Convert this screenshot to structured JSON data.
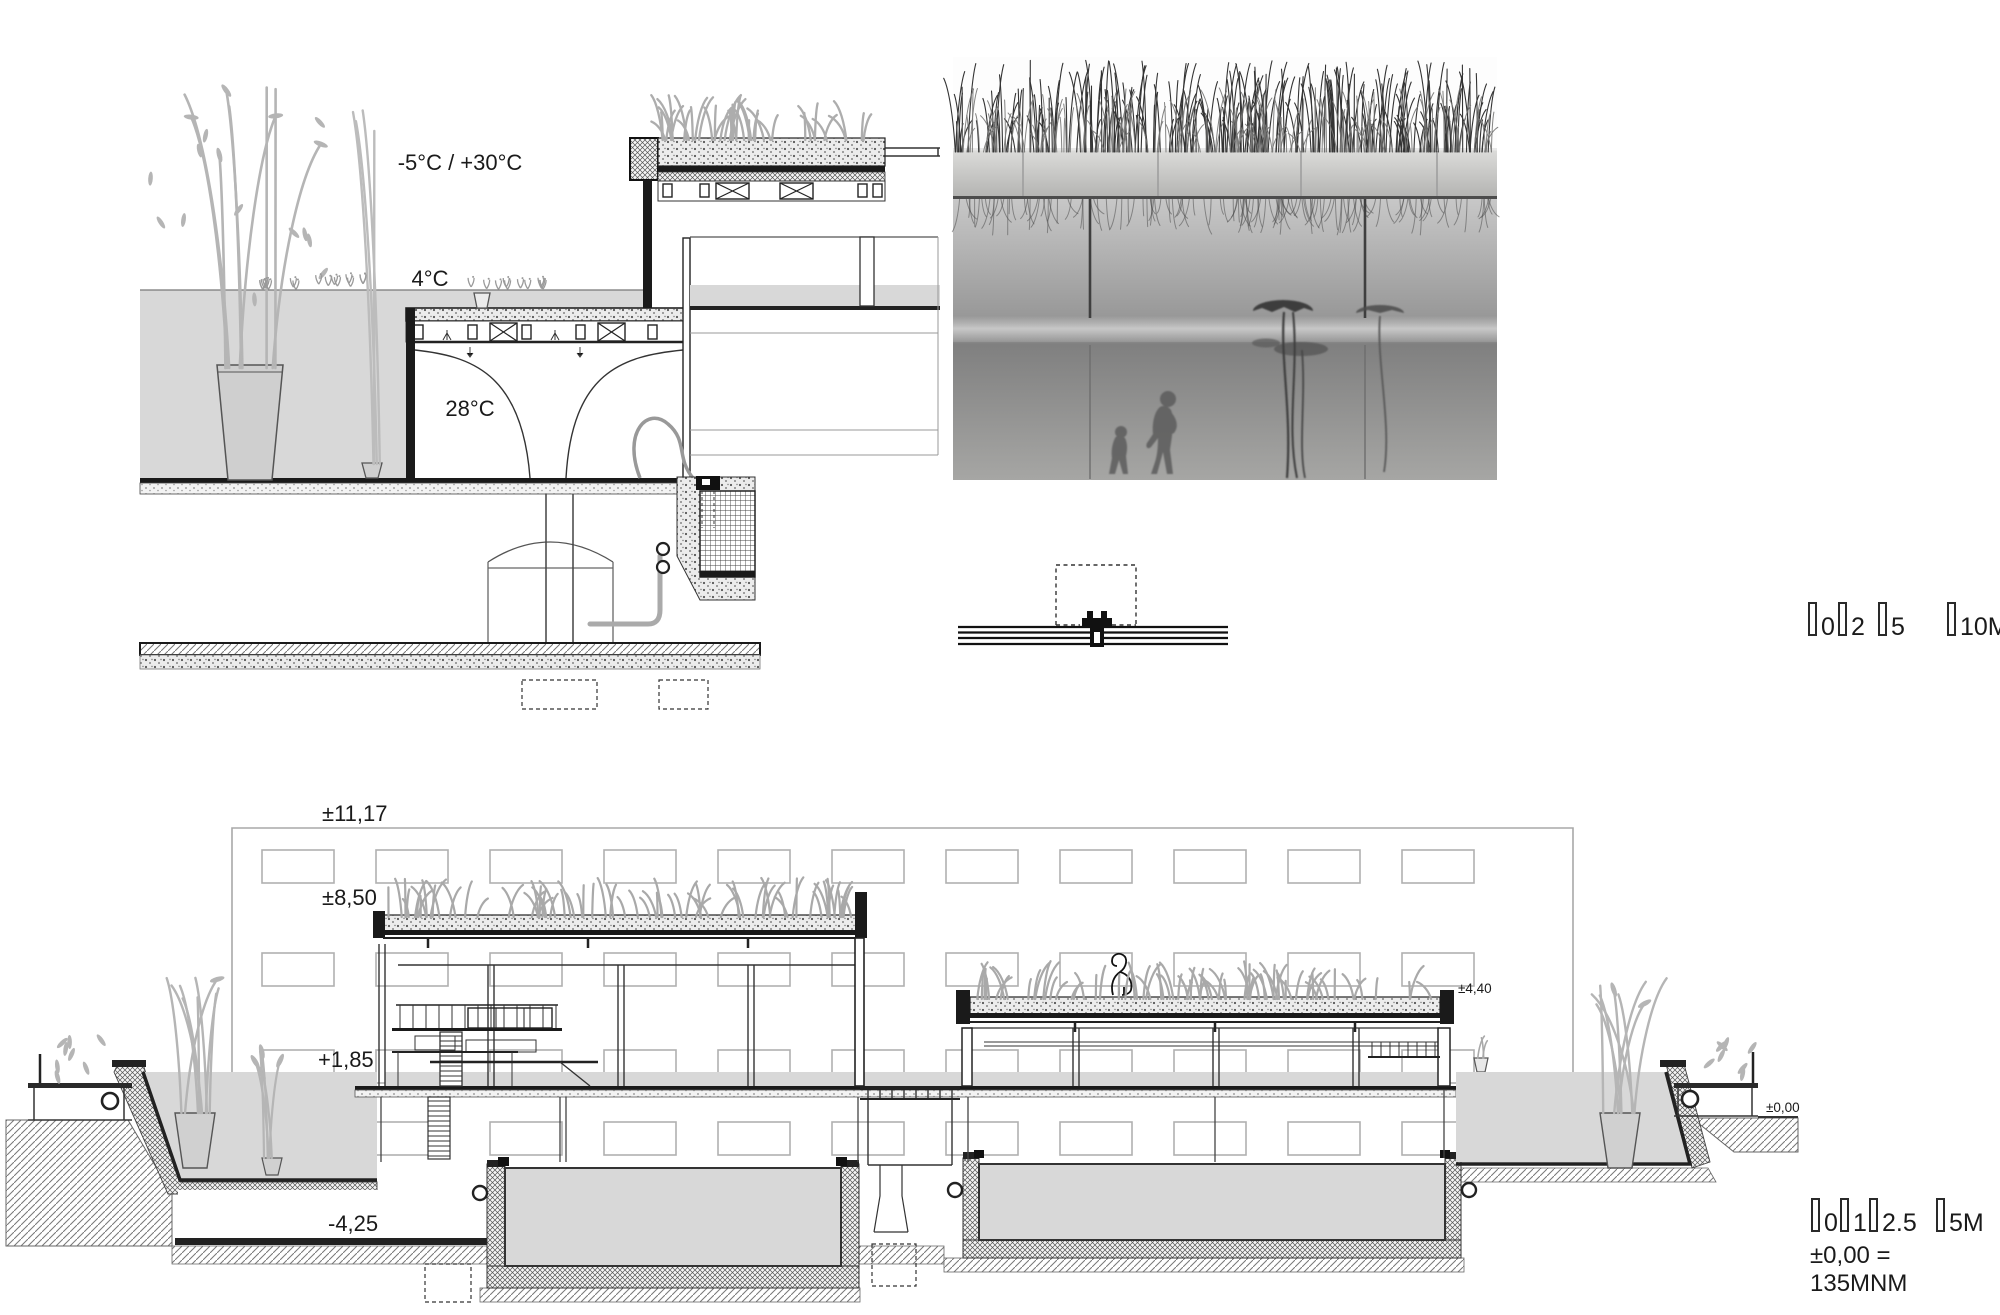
{
  "detail_section": {
    "air_temp": "-5°C / +30°C",
    "outdoor_water_temp": "4°C",
    "indoor_water_temp": "28°C"
  },
  "long_section": {
    "levels": {
      "parapet_top": "±11,17",
      "main_roof": "±8,50",
      "water_level": "+1,85",
      "basement_floor": "-4,25",
      "low_roof": "±4,40",
      "ground": "±0,00"
    }
  },
  "scale_bar_top": {
    "labels": [
      "0",
      "2",
      "5",
      "10M"
    ]
  },
  "scale_bar_bottom": {
    "labels": [
      "0",
      "1",
      "2.5",
      "5M"
    ],
    "datum_note": "±0,00 = 135MNM"
  },
  "colors": {
    "pool_water_fill": "#d8d8d8",
    "drawing_line": "#1a1a1a",
    "background_grid_line": "#a8a8a8",
    "vegetation_gray": "#adadad"
  }
}
